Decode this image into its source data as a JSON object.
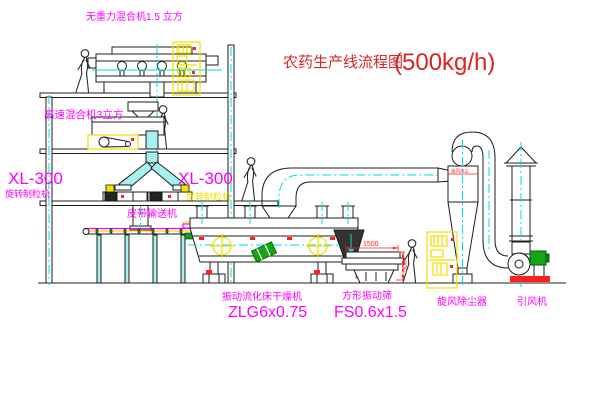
{
  "title": {
    "text_cn": "农药生产线流程图",
    "capacity": "(500kg/h)"
  },
  "equipment_labels": {
    "gravity_free_mixer": "无重力混合机1.5 立方",
    "high_speed_mixer": "高速混合机3立方",
    "granulator_left_model": "XL-300",
    "granulator_left_name": "旋转制粒机",
    "granulator_right_model": "XL-300",
    "granulator_right_name": "旋转制粒机",
    "belt_conveyor": "皮带输送机",
    "fluid_bed_dryer_name": "振动流化床干燥机",
    "fluid_bed_dryer_model": "ZLG6x0.75",
    "vibrating_screen_name": "方形振动筛",
    "vibrating_screen_model": "FS0.6x1.5",
    "cyclone_dust_collector": "旋风除尘器",
    "induced_draft_fan": "引风机",
    "cyclone_body_tag": "旋风除尘"
  },
  "dimensions": {
    "screen_length": "1500",
    "screen_height": "500"
  },
  "colors": {
    "line": "#1c1c1c",
    "magenta": "#ff00ff",
    "red": "#d92525",
    "dim": "#ff1f1f",
    "yellow": "#f0df00",
    "cyan": "#00dede",
    "cyan_fill": "#a8f0f0",
    "green": "#12a312"
  }
}
